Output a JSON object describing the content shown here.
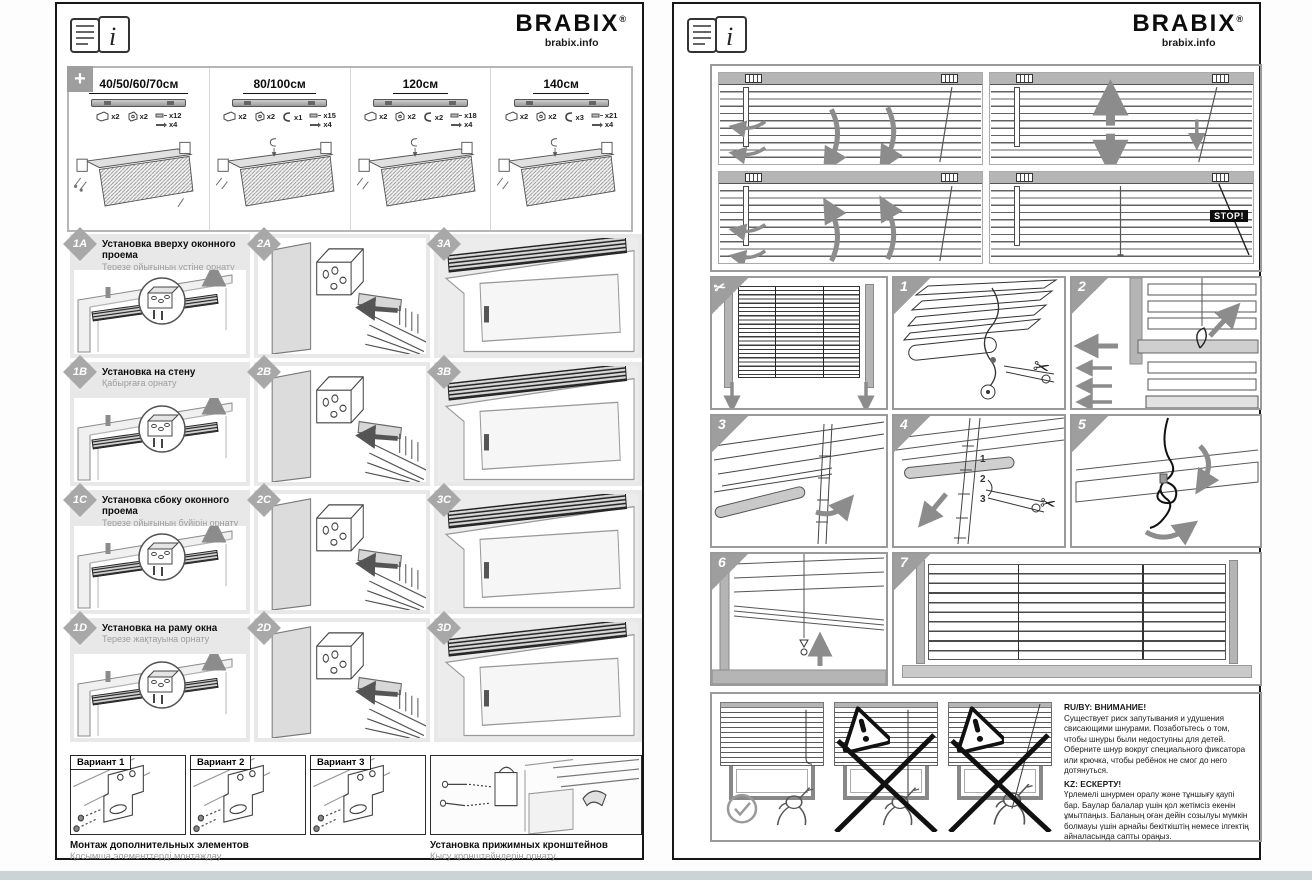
{
  "symbols": {
    "plus": "+",
    "scissors": "✂",
    "info": "i"
  },
  "page_left": {
    "header": {
      "brand": "BRABIX",
      "reg": "®",
      "site": "brabix.info"
    },
    "kit": {
      "sizes": [
        {
          "label": "40/50/60/70см",
          "counts": [
            "x2",
            "x2",
            "x12",
            "x4"
          ]
        },
        {
          "label": "80/100см",
          "counts": [
            "x2",
            "x2",
            "x1",
            "x15",
            "x4"
          ]
        },
        {
          "label": "120см",
          "counts": [
            "x2",
            "x2",
            "x2",
            "x18",
            "x4"
          ]
        },
        {
          "label": "140см",
          "counts": [
            "x2",
            "x2",
            "x3",
            "x21",
            "x4"
          ]
        }
      ]
    },
    "rows": [
      {
        "badge": "1A",
        "title": "Установка вверху оконного проема",
        "subtitle": "Терезе ойығының үстіне орнату",
        "badge2": "2A",
        "badge3": "3A"
      },
      {
        "badge": "1B",
        "title": "Установка на стену",
        "subtitle": "Қабырғаға орнату",
        "badge2": "2B",
        "badge3": "3B"
      },
      {
        "badge": "1C",
        "title": "Установка сбоку оконного проема",
        "subtitle": "Терезе ойығының бүйірін орнату",
        "badge2": "2C",
        "badge3": "3C"
      },
      {
        "badge": "1D",
        "title": "Установка на раму окна",
        "subtitle": "Терезе жақтауына орнату",
        "badge2": "2D",
        "badge3": "3D"
      }
    ],
    "variants": [
      "Вариант 1",
      "Вариант 2",
      "Вариант 3"
    ],
    "captions": {
      "left_title": "Монтаж дополнительных элементов",
      "left_sub": "Қосымша элементтерді монтаждау",
      "right_title": "Установка прижимных кронштейнов",
      "right_sub": "Қысу кронштейндерін орнату"
    }
  },
  "page_right": {
    "header": {
      "brand": "BRABIX",
      "reg": "®",
      "site": "brabix.info"
    },
    "stop_label": "STOP!",
    "step_numbers": [
      "1",
      "2",
      "3",
      "4",
      "5",
      "6",
      "7"
    ],
    "ladder_marks": [
      "1",
      "2",
      "3"
    ],
    "warning": {
      "ru_title": "RU/BY: ВНИМАНИЕ!",
      "ru_text": "Существует риск запутывания и удушения свисающими шнурами. Позаботьтесь о том, чтобы шнуры были недоступны для детей. Оберните шнур вокруг специального фиксатора или крючка, чтобы ребёнок не смог до него дотянуться.",
      "kz_title": "KZ: ЕСКЕРТУ!",
      "kz_text": "Үрлемелі шнурмен оралу және тұншығу қаупі бар. Баулар балалар үшін қол жетімсіз екенін ұмытпаңыз. Баланың оған дейін созылуы мүмкін болмауы үшін арнайы бекіткіштің немесе ілгектің айналасында сапты ораңыз."
    }
  }
}
